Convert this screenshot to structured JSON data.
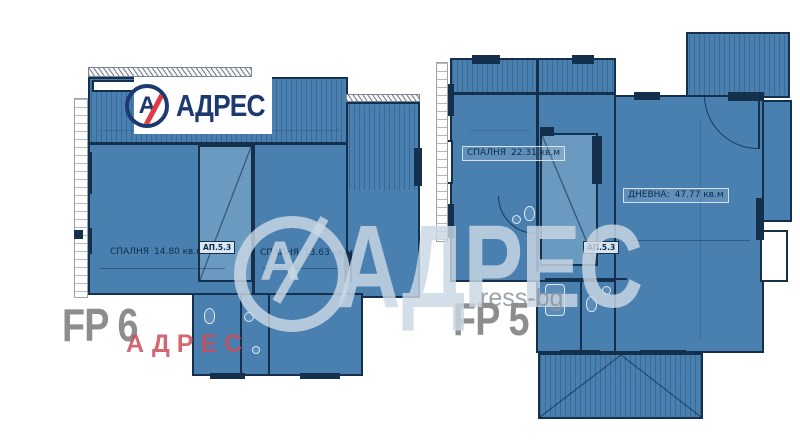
{
  "brand": {
    "monogram": "А",
    "name": "АДРЕС"
  },
  "watermarks": {
    "center_monogram": "А",
    "center_name": "АДРЕС",
    "pink": "АДРЕС",
    "url": "ress-bg"
  },
  "plans": [
    {
      "code": "FP 6",
      "tag": "АП.5.3",
      "rooms": [
        {
          "name": "СПАЛНЯ",
          "area": "14.80 кв.м"
        },
        {
          "name": "СПАЛНЯ",
          "area": "13.63 кв.м"
        }
      ]
    },
    {
      "code": "FP 5",
      "tag": "АП.5.3",
      "rooms": [
        {
          "name": "СПАЛНЯ",
          "area": "22.31 кв.м"
        },
        {
          "name": "ДНЕВНА:",
          "area": "47.77 кв.м"
        }
      ]
    }
  ],
  "colors": {
    "plan_fill": "#4a80b0",
    "wall": "#14304d",
    "stair_fill": "#6b9ac0",
    "logo_navy": "#1d3a70",
    "logo_red": "#e23a45",
    "fp_label": "#8d8d8d",
    "watermark_light": "#cad8e4",
    "watermark_pink": "#c8505c",
    "url_gray": "#8a949e",
    "paper": "#ffffff"
  }
}
